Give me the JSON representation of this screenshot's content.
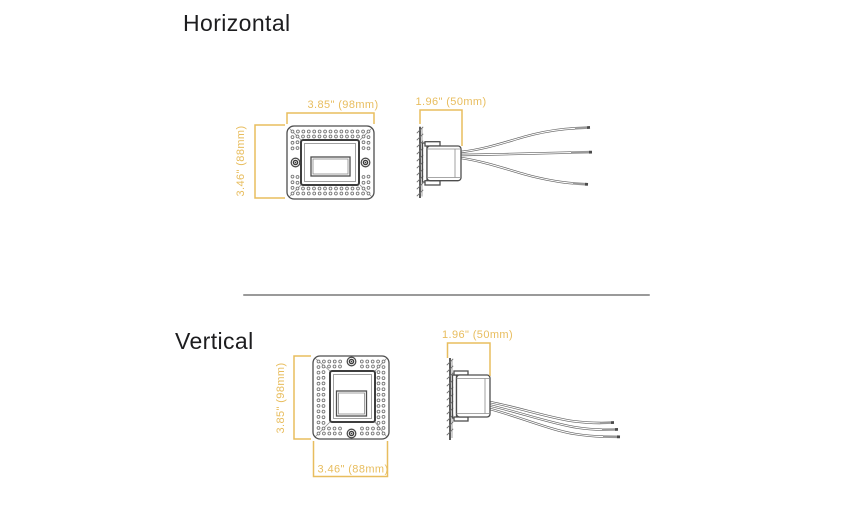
{
  "colors": {
    "dimension": "#e8bd5e",
    "outline": "#4d4d4d",
    "divider": "#9a9a9a",
    "title": "#1d1d1f"
  },
  "sections": {
    "horizontal": {
      "title": "Horizontal",
      "front": {
        "width": "3.85\" (98mm)",
        "height": "3.46\" (88mm)"
      },
      "side": {
        "depth": "1.96\" (50mm)"
      }
    },
    "vertical": {
      "title": "Vertical",
      "front": {
        "height": "3.85\" (98mm)",
        "width": "3.46\" (88mm)"
      },
      "side": {
        "depth": "1.96\" (50mm)"
      }
    }
  }
}
